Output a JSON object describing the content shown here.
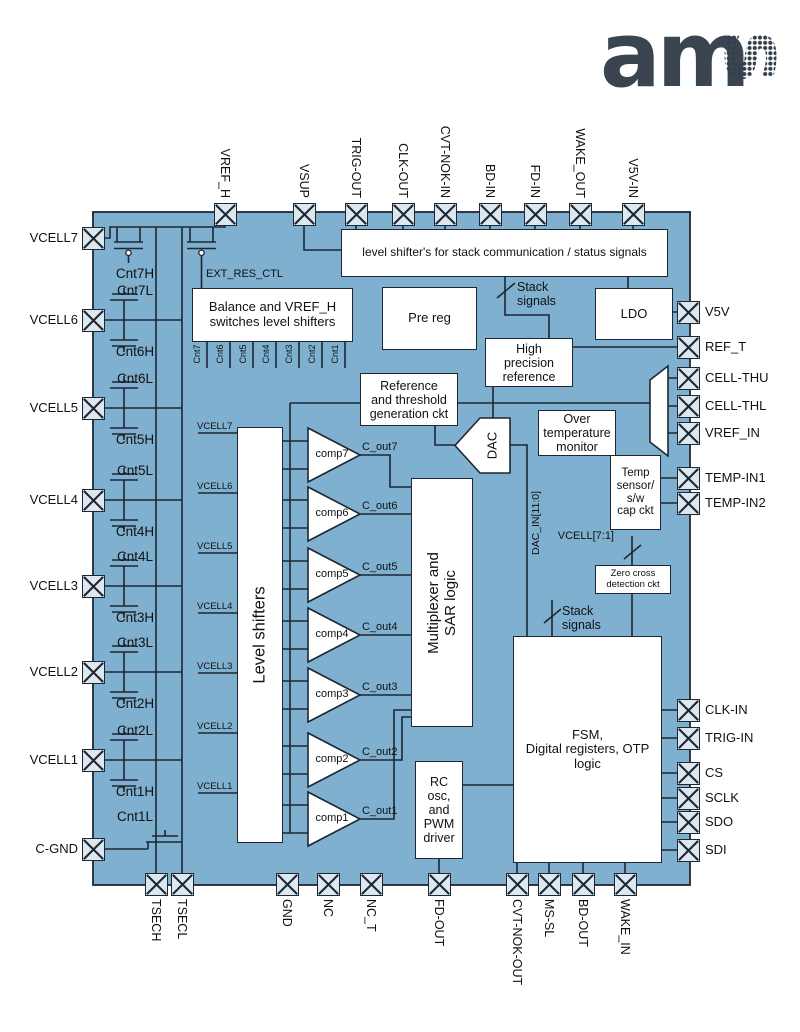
{
  "logo": {
    "solid": "am",
    "dotted": "s"
  },
  "colors": {
    "diagram_fill": "#7fb0d0",
    "pin_fill": "#dde7f0",
    "line": "#1d2733",
    "box_fill": "#ffffff",
    "logo_solid": "#3a4550",
    "logo_dots": "#333f4c"
  },
  "diagram": {
    "pins": {
      "top": [
        {
          "label": "VREF_H",
          "x": 225
        },
        {
          "label": "VSUP",
          "x": 304
        },
        {
          "label": "TRIG-OUT",
          "x": 356
        },
        {
          "label": "CLK-OUT",
          "x": 403
        },
        {
          "label": "CVT-NOK-IN",
          "x": 445
        },
        {
          "label": "BD-IN",
          "x": 490
        },
        {
          "label": "FD-IN",
          "x": 535
        },
        {
          "label": "WAKE_OUT",
          "x": 580
        },
        {
          "label": "V5V-IN",
          "x": 633
        }
      ],
      "left": [
        {
          "label": "VCELL7",
          "y": 238
        },
        {
          "label": "VCELL6",
          "y": 320
        },
        {
          "label": "VCELL5",
          "y": 408
        },
        {
          "label": "VCELL4",
          "y": 500
        },
        {
          "label": "VCELL3",
          "y": 586
        },
        {
          "label": "VCELL2",
          "y": 672
        },
        {
          "label": "VCELL1",
          "y": 760
        },
        {
          "label": "C-GND",
          "y": 849
        }
      ],
      "right": [
        {
          "label": "V5V",
          "y": 312
        },
        {
          "label": "REF_T",
          "y": 347
        },
        {
          "label": "CELL-THU",
          "y": 378
        },
        {
          "label": "CELL-THL",
          "y": 406
        },
        {
          "label": "VREF_IN",
          "y": 433
        },
        {
          "label": "TEMP-IN1",
          "y": 478
        },
        {
          "label": "TEMP-IN2",
          "y": 503
        },
        {
          "label": "CLK-IN",
          "y": 710
        },
        {
          "label": "TRIG-IN",
          "y": 738
        },
        {
          "label": "CS",
          "y": 773
        },
        {
          "label": "SCLK",
          "y": 798
        },
        {
          "label": "SDO",
          "y": 822
        },
        {
          "label": "SDI",
          "y": 850
        }
      ],
      "bottom": [
        {
          "label": "TSECH",
          "x": 156
        },
        {
          "label": "TSECL",
          "x": 182
        },
        {
          "label": "GND",
          "x": 287
        },
        {
          "label": "NC",
          "x": 328
        },
        {
          "label": "NC_T",
          "x": 371
        },
        {
          "label": "FD-OUT",
          "x": 439
        },
        {
          "label": "CVT-NOK-OUT",
          "x": 517
        },
        {
          "label": "MS-SL",
          "x": 549
        },
        {
          "label": "BD-OUT",
          "x": 583
        },
        {
          "label": "WAKE_IN",
          "x": 625
        }
      ]
    },
    "blocks": {
      "stack_level_shifters": "level shifter's for stack communication / status signals",
      "balance": "Balance and VREF_H\nswitches level shifters",
      "pre_reg": "Pre reg",
      "ldo": "LDO",
      "high_precision": "High\nprecision\nreference",
      "ref_threshold": "Reference\nand threshold\ngeneration ckt",
      "over_temp": "Over\ntemperature\nmonitor",
      "temp_sensor": "Temp\nsensor/\ns/w\ncap ckt",
      "zero_cross": "Zero cross\ndetection ckt",
      "level_shifters": "Level shifters",
      "mux_sar": "Multiplexer and\nSAR logic",
      "fsm": "FSM,\nDigital registers,  OTP\nlogic",
      "rc_osc": "RC\nosc,\nand\nPWM\ndriver",
      "dac": "DAC"
    },
    "comparators": [
      {
        "label": "comp7",
        "out": "C_out7",
        "y": 455
      },
      {
        "label": "comp6",
        "out": "C_out6",
        "y": 514
      },
      {
        "label": "comp5",
        "out": "C_out5",
        "y": 575
      },
      {
        "label": "comp4",
        "out": "C_out4",
        "y": 635
      },
      {
        "label": "comp3",
        "out": "C_out3",
        "y": 695
      },
      {
        "label": "comp2",
        "out": "C_out2",
        "y": 760
      },
      {
        "label": "comp1",
        "out": "C_out1",
        "y": 819
      }
    ],
    "vcell_inputs": [
      {
        "label": "VCELL7",
        "y": 433
      },
      {
        "label": "VCELL6",
        "y": 493
      },
      {
        "label": "VCELL5",
        "y": 553
      },
      {
        "label": "VCELL4",
        "y": 613
      },
      {
        "label": "VCELL3",
        "y": 673
      },
      {
        "label": "VCELL2",
        "y": 733
      },
      {
        "label": "VCELL1",
        "y": 793
      }
    ],
    "cnt_outputs": [
      {
        "label": "Cnt7",
        "x": 207
      },
      {
        "label": "Cnt6",
        "x": 230
      },
      {
        "label": "Cnt5",
        "x": 253
      },
      {
        "label": "Cnt4",
        "x": 276
      },
      {
        "label": "Cnt3",
        "x": 299
      },
      {
        "label": "Cnt2",
        "x": 322
      },
      {
        "label": "Cnt1",
        "x": 345
      }
    ],
    "balance_switches": [
      {
        "top": "Cnt7L",
        "bottom": "Cnt6H",
        "y": 320
      },
      {
        "top": "Cnt6L",
        "bottom": "Cnt5H",
        "y": 408
      },
      {
        "top": "Cnt5L",
        "bottom": "Cnt4H",
        "y": 500
      },
      {
        "top": "Cnt4L",
        "bottom": "Cnt3H",
        "y": 586
      },
      {
        "top": "Cnt3L",
        "bottom": "Cnt2H",
        "y": 672
      },
      {
        "top": "Cnt2L",
        "bottom": "Cnt1H",
        "y": 760
      }
    ],
    "single_switches": [
      {
        "label": "Cnt7H",
        "x": 104,
        "y": 266
      },
      {
        "label": "Cnt1L",
        "x": 104,
        "y": 809
      }
    ],
    "net_labels": {
      "ext_res_ctl": "EXT_RES_CTL",
      "stack_signals_top": "Stack\nsignals",
      "stack_signals_bottom": "Stack\nsignals",
      "vcell_bus": "VCELL[7:1]",
      "dac_in": "DAC_IN[11:0]"
    }
  }
}
